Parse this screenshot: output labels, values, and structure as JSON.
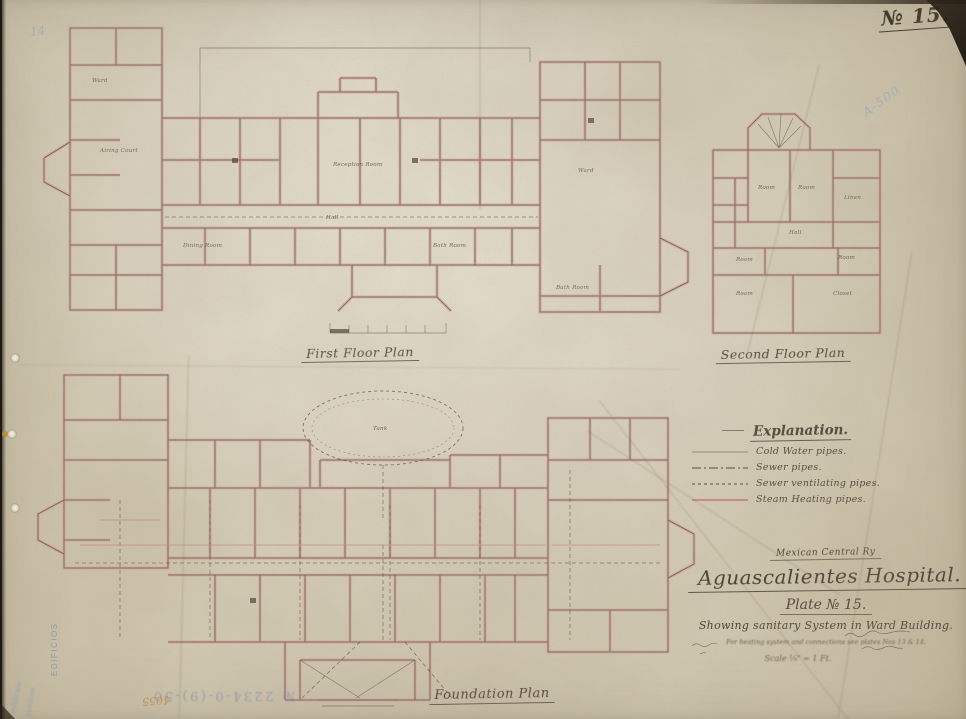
{
  "sheet": {
    "plate_number": "№ 15.",
    "blue_reference": "A-500",
    "pencil_note": "14",
    "stamp_number": "№ 2234-0-(9)-50",
    "stamp_scribble": "4055",
    "margin_vertical_text": "EDIFICIOS",
    "margin_script_1": "edificios",
    "margin_script_2": "publicos"
  },
  "plans": {
    "first": {
      "title": "First Floor Plan",
      "rooms": [
        "Airing Court",
        "Reception Room",
        "Hall",
        "Ward",
        "Bath Room",
        "Dining Room",
        "Ward",
        "Bath Room"
      ]
    },
    "second": {
      "title": "Second Floor Plan",
      "rooms": [
        "Room",
        "Room",
        "Linen",
        "Hall",
        "Room",
        "Room",
        "Room",
        "Closet"
      ]
    },
    "foundation": {
      "title": "Foundation Plan",
      "tank_label": "Tank"
    }
  },
  "legend": {
    "title": "Explanation.",
    "items": [
      {
        "label": "Cold Water pipes.",
        "line_style": "thin-solid"
      },
      {
        "label": "Sewer pipes.",
        "line_style": "dash-dot"
      },
      {
        "label": "Sewer ventilating pipes.",
        "line_style": "dashed"
      },
      {
        "label": "Steam Heating pipes.",
        "line_style": "solid-pink"
      }
    ]
  },
  "title_block": {
    "railway": "Mexican Central Ry",
    "title": "Aguascalientes Hospital.",
    "plate": "Plate № 15.",
    "subtitle": "Showing sanitary System in Ward Building.",
    "note": "For heating system and connections see plates Nos 13 & 14.",
    "scale_note": "Scale ⅛\" = 1 Ft."
  },
  "colors": {
    "paper": "#d8d0bc",
    "ink": "#43392d",
    "wall_pink": "#d2a098",
    "pencil_blue": "#7d98c2",
    "stamp_blue": "#5d79b8"
  }
}
